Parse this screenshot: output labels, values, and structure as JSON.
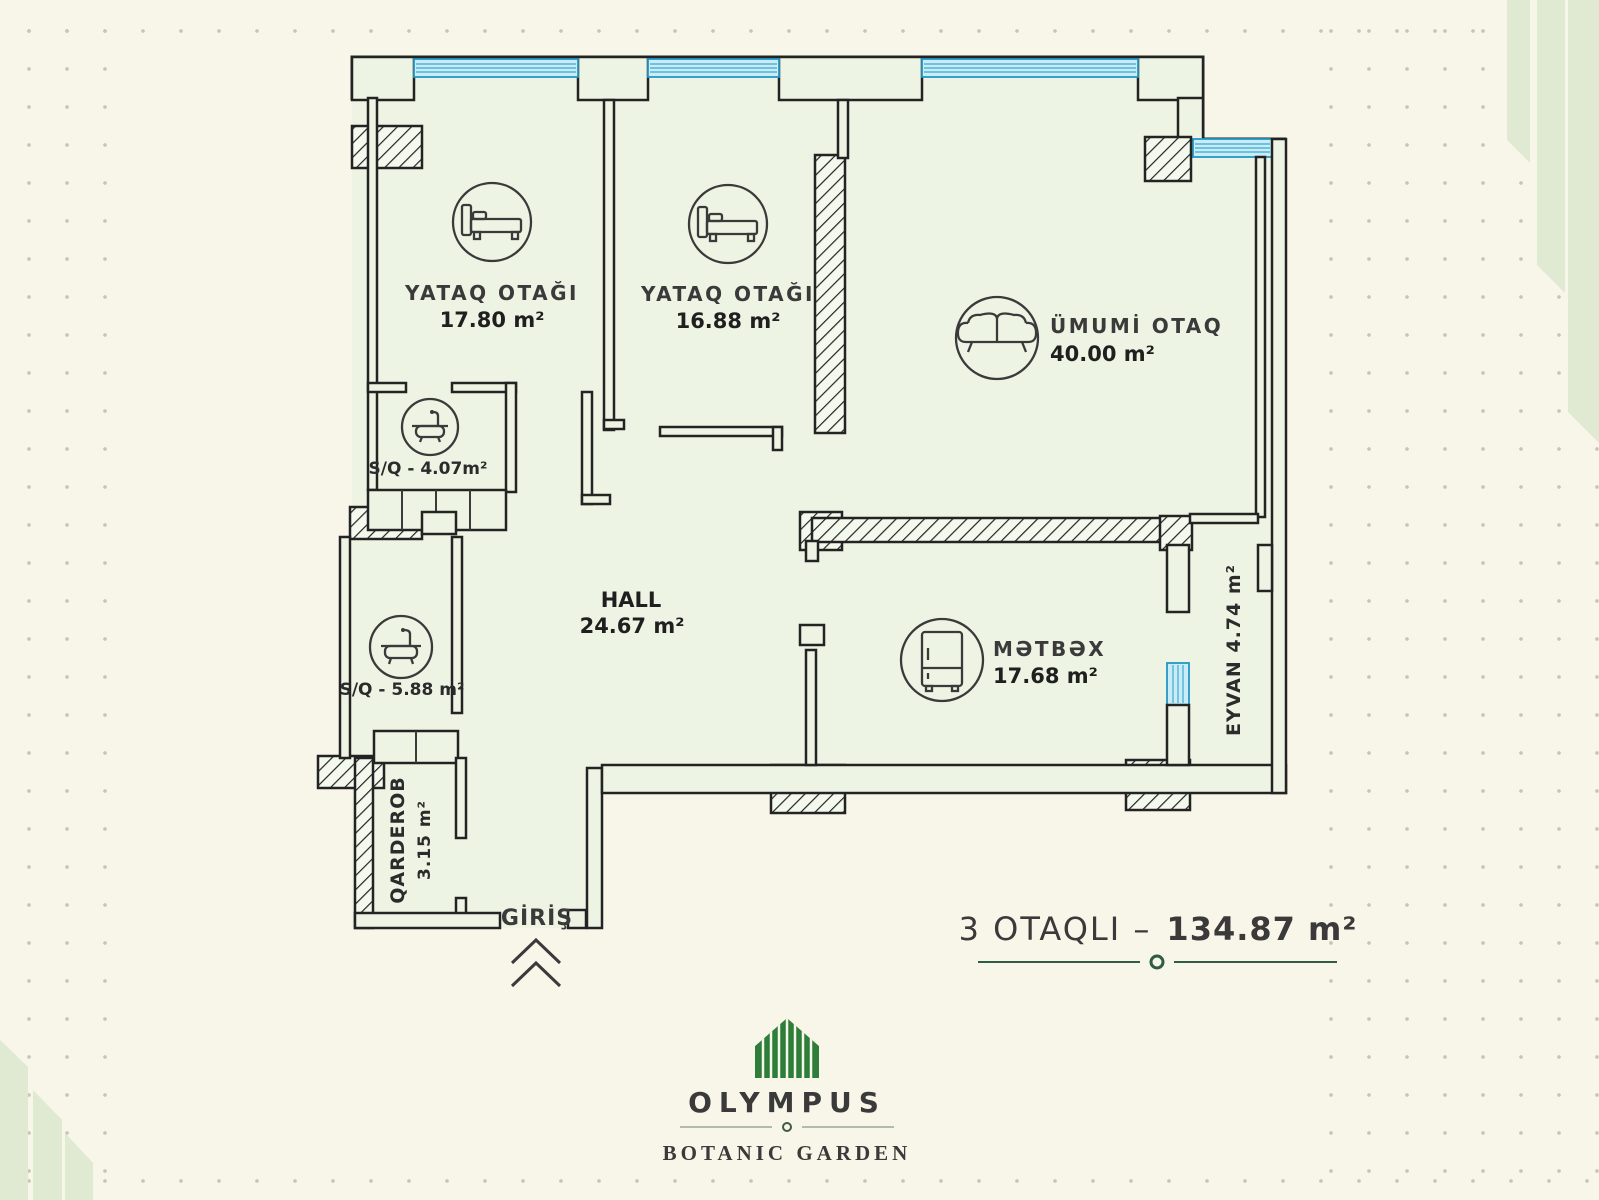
{
  "page": {
    "background": "#f8f5e9",
    "plan_background": "#edf4e3",
    "wall_color": "#232323",
    "window_color": "#c9ecf7",
    "entrance_red": "#d8232a",
    "green_dark": "#2e5c44",
    "green_brand": "#2e7d3a"
  },
  "icons": {
    "bedroom1": "bed-icon",
    "bedroom2": "bed-icon",
    "living": "sofa-icon",
    "bath1": "bathtub-icon",
    "bath2": "bathtub-icon",
    "kitchen": "fridge-icon",
    "entrance": "chevron-up-icon"
  },
  "rooms": {
    "bedroom1": {
      "name": "YATAQ OTAĞI",
      "area": "17.80 m²"
    },
    "bedroom2": {
      "name": "YATAQ OTAĞI",
      "area": "16.88 m²"
    },
    "living": {
      "name": "ÜMUMİ OTAQ",
      "area": "40.00 m²"
    },
    "bath1": {
      "label": "S/Q - 4.07m²"
    },
    "bath2": {
      "label": "S/Q - 5.88 m²"
    },
    "hall": {
      "name": "HALL",
      "area": "24.67 m²"
    },
    "kitchen": {
      "name": "MƏTBƏX",
      "area": "17.68 m²"
    },
    "balcony": {
      "label": "EYVAN 4.74 m²"
    },
    "wardrobe": {
      "name": "QARDEROB",
      "area": "3.15 m²"
    },
    "entrance": {
      "label": "GİRİŞ"
    }
  },
  "footer": {
    "type_label": "3 OTAQLI –",
    "area_value": "134.87 m²"
  },
  "brand": {
    "name": "OLYMPUS",
    "tagline": "BOTANIC GARDEN"
  }
}
